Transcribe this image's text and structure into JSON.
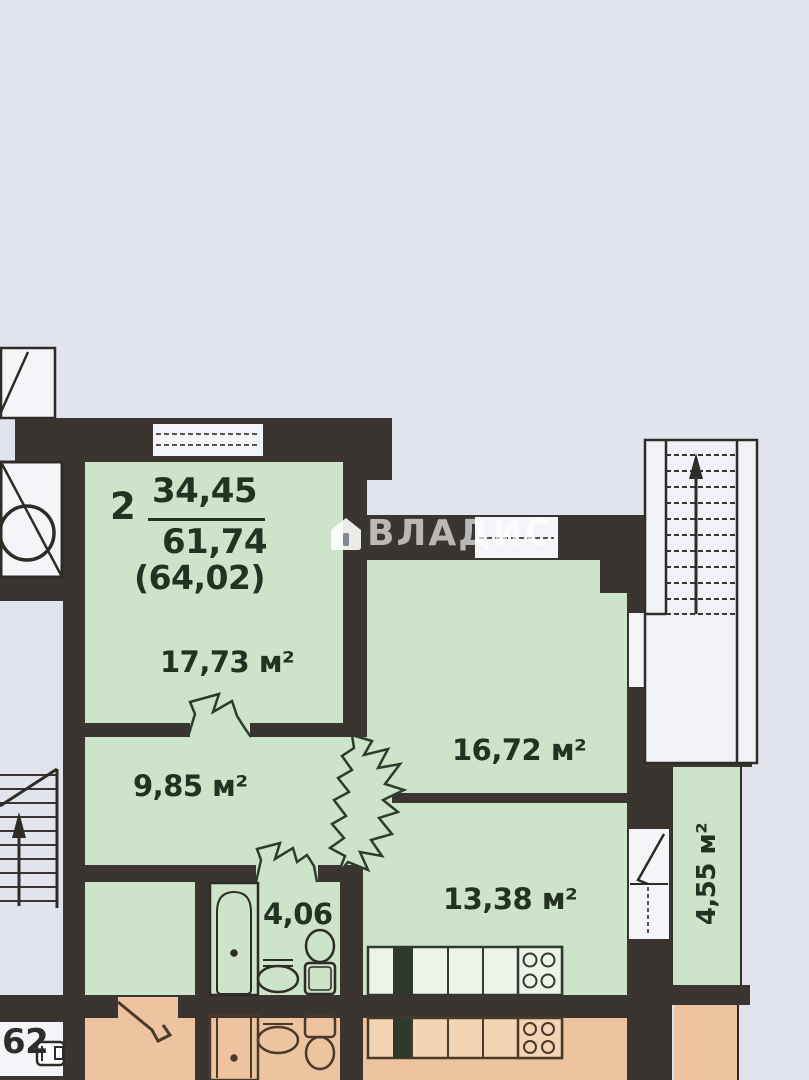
{
  "apartment": {
    "rooms_count": "2",
    "living_area": "34,45",
    "total_area": "61,74",
    "total_with_balcony": "(64,02)"
  },
  "rooms": {
    "living": "17,73 м²",
    "bedroom": "16,72 м²",
    "hallway": "9,85 м²",
    "kitchen": "13,38 м²",
    "bathroom": "4,06",
    "balcony": "4,55 м²"
  },
  "neighbor_apartment_label": "62",
  "watermark": {
    "text": "ВЛАДИС",
    "icon": "house-icon"
  },
  "icons": {
    "stairs_up_main": "up-arrow-icon",
    "stairs_up_left": "up-arrow-icon",
    "elevator": "elevator-cross-circle-icon",
    "bath": "bathtub-symbol",
    "sink": "sink-symbol",
    "toilet": "toilet-symbol",
    "stove": "stove-4-burner-symbol"
  },
  "colors": {
    "background": "#e2e4ed",
    "wall": "#3a3531",
    "room_fill": "#cde3ca",
    "neighbor_fill": "#edc49f",
    "paper_white": "#f4f5f8",
    "label_text": "#243224"
  }
}
